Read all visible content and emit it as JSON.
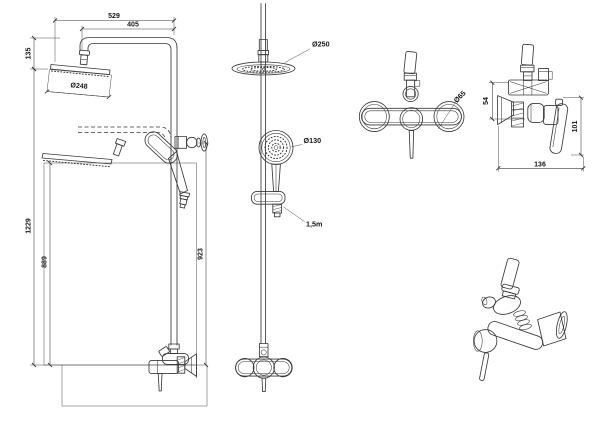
{
  "drawing": {
    "background": "#ffffff",
    "line_color": "#3a3a3a",
    "views": {
      "shower_column_side": {
        "dims": {
          "total_width": "529",
          "arm_reach": "405",
          "head_offset": "135",
          "head_diameter": "Ø248",
          "total_height": "1229",
          "lower_head_height": "889",
          "rail_height": "923"
        }
      },
      "shower_column_front": {
        "labels": {
          "rain_head_diameter": "Ø250",
          "hand_shower_diameter": "Ø130",
          "hose_length": "1,5m"
        }
      },
      "mixer_front": {
        "labels": {
          "escutcheon_diameter": "Ø65"
        }
      },
      "mixer_side": {
        "dims": {
          "outlet_offset": "54",
          "handle_height": "101",
          "depth": "136"
        }
      }
    }
  }
}
